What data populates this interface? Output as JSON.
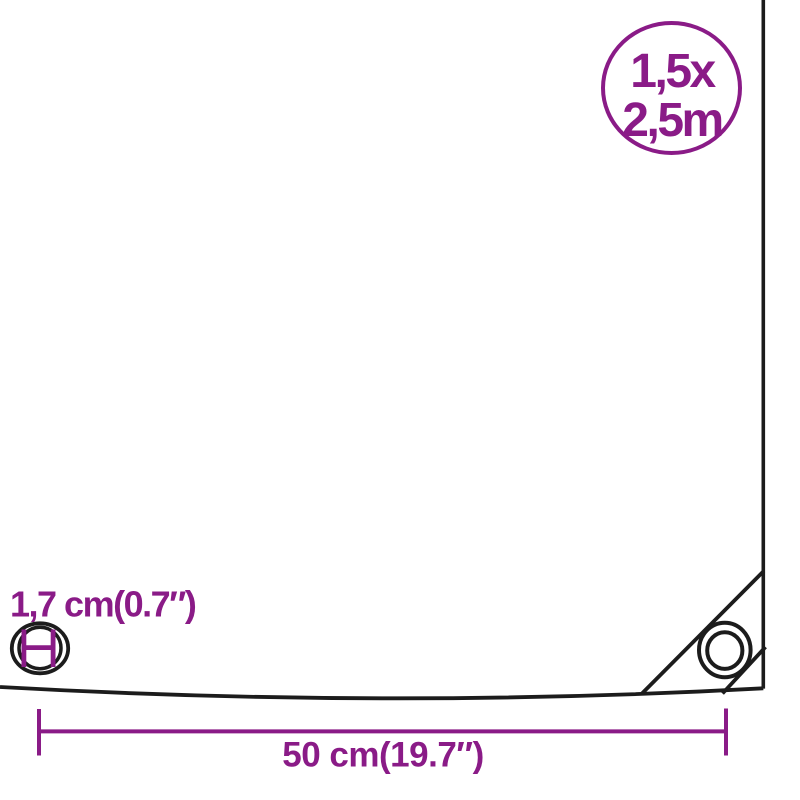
{
  "diagram": {
    "kind": "tarpaulin-dimension-diagram",
    "size_badge": {
      "line1": "1,5x",
      "line2": "2,5m"
    },
    "labels": {
      "eyelet_diameter": "1,7 cm(0.7″)",
      "eyelet_spacing": "50 cm(19.7″)"
    }
  },
  "colors": {
    "accent": "#8A1B87",
    "line": "#1C1C1C",
    "background": "#ffffff"
  }
}
